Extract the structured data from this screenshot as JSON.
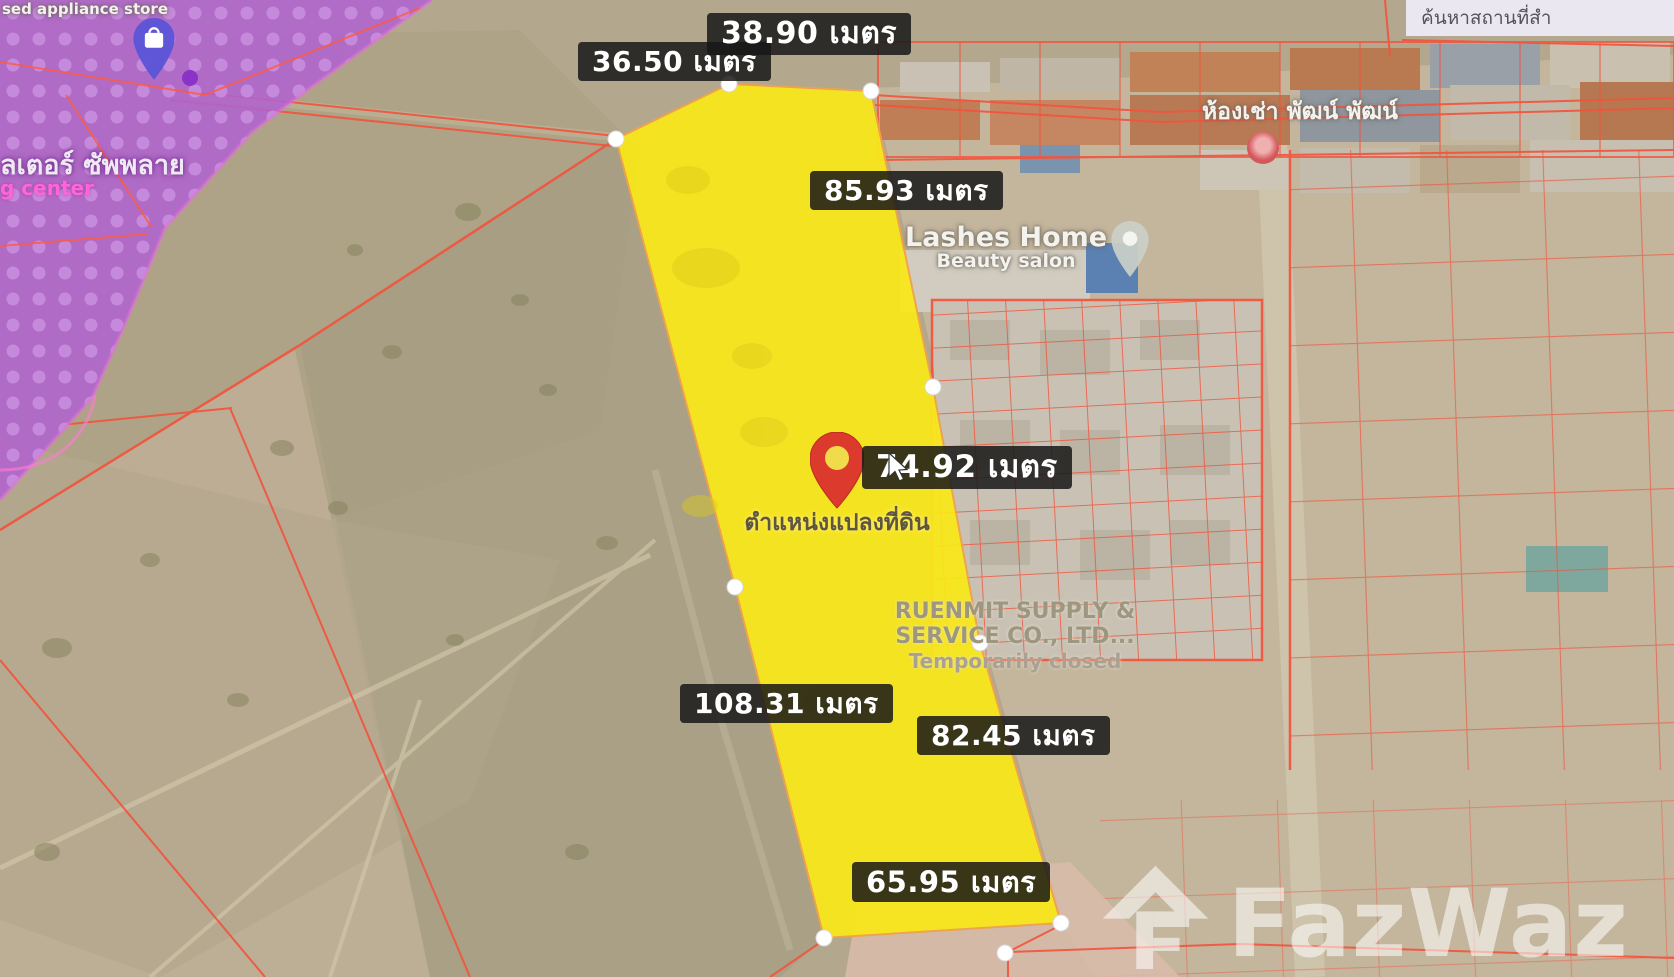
{
  "app": {
    "search_placeholder": "ค้นหาสถานที่สำ"
  },
  "measurements": {
    "unit": "เมตร",
    "top_left": "36.50 เมตร",
    "top": "38.90 เมตร",
    "right_upper": "85.93 เมตร",
    "middle": "74.92 เมตร",
    "left_lower": "108.31 เมตร",
    "right_lower": "82.45 เมตร",
    "bottom": "65.95 เมตร"
  },
  "plot": {
    "caption": "ตำแหน่งแปลงที่ดิน",
    "points": "616,139 729,84 871,91 933,387 980,643 1061,923 824,938 735,587",
    "vertices": [
      [
        616,
        139
      ],
      [
        729,
        84
      ],
      [
        871,
        91
      ],
      [
        933,
        387
      ],
      [
        980,
        643
      ],
      [
        1061,
        923
      ],
      [
        824,
        938
      ],
      [
        735,
        587
      ],
      [
        1005,
        953
      ]
    ]
  },
  "pois": {
    "lashes_home": {
      "name": "Lashes Home",
      "category": "Beauty salon"
    },
    "ruenmit": {
      "name_line1": "RUENMIT SUPPLY &",
      "name_line2": "SERVICE CO., LTD...",
      "status": "Temporarily closed"
    },
    "rental": {
      "name": "ห้องเช่า พัฒน์ พัฒน์"
    },
    "appliance_store": {
      "name": "sed appliance store"
    },
    "supply_store": {
      "name": "ลเตอร์ ซัพพลาย"
    },
    "center": {
      "name": "g center"
    }
  },
  "watermark": {
    "brand": "FazWaz"
  },
  "colors": {
    "plot_fill": "#f9e818",
    "plot_outline": "#f0a24a",
    "parcel_line": "#f2543d",
    "zone_overlay": "#b163cf",
    "label_bg": "rgba(24,24,24,0.85)",
    "pin_red": "#dc3a2c"
  }
}
